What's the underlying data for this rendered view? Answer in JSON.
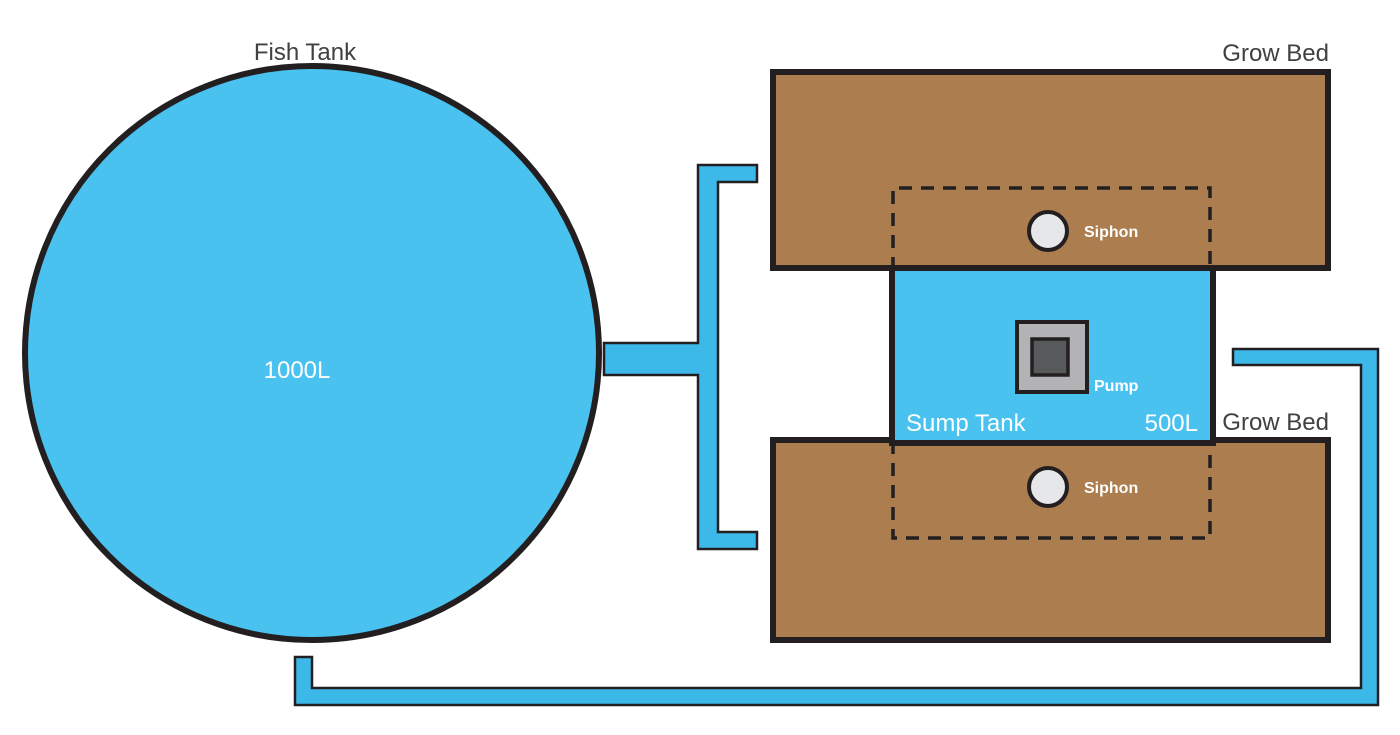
{
  "diagram": {
    "title": "Aquaponics system diagram",
    "fish_tank": {
      "label": "Fish Tank",
      "capacity": "1000L"
    },
    "sump_tank": {
      "label": "Sump Tank",
      "capacity": "500L"
    },
    "pump": {
      "label": "Pump"
    },
    "grow_bed_top": {
      "label": "Grow Bed",
      "siphon_label": "Siphon"
    },
    "grow_bed_bottom": {
      "label": "Grow Bed",
      "siphon_label": "Siphon"
    }
  },
  "colors": {
    "water_blue": "#4AC2EF",
    "pipe_blue": "#3CB9E8",
    "bed_brown": "#AC7D4F",
    "outline_black": "#231F20",
    "pump_outer_gray": "#B3B3B5",
    "pump_inner_gray": "#58595B",
    "siphon_fill": "#E6E7E8",
    "text_dark": "#414042",
    "text_light": "#FFFFFF"
  }
}
